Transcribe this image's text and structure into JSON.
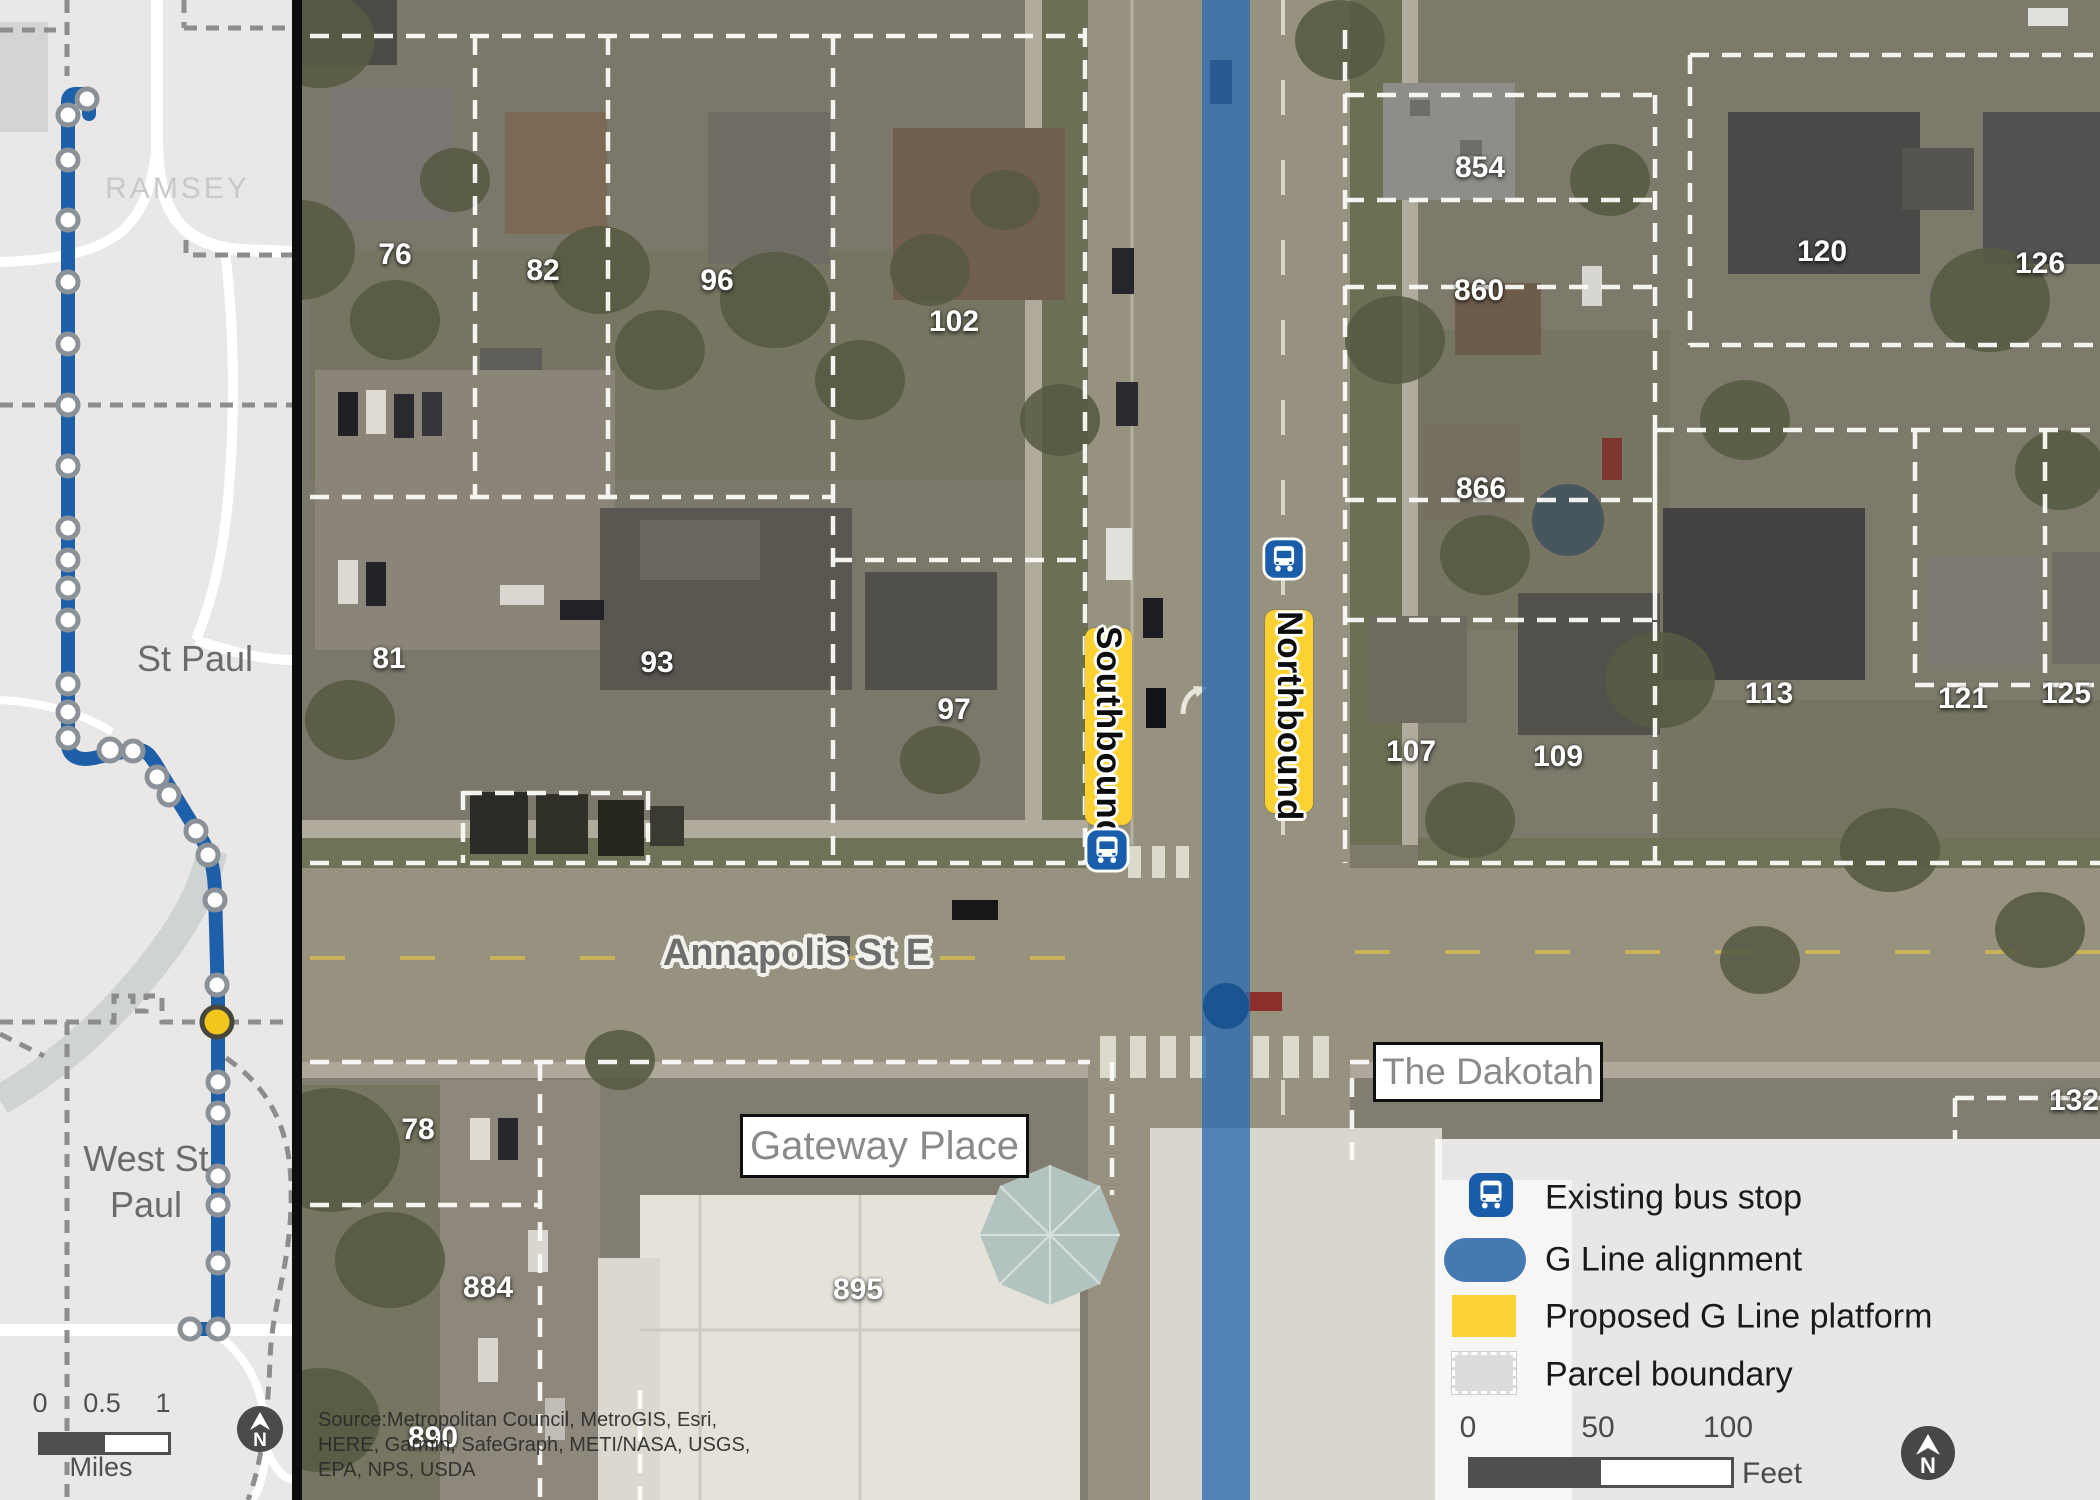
{
  "overview_map": {
    "county_label": "RAMSEY",
    "city1_label": "St Paul",
    "city2_line1": "West St",
    "city2_line2": "Paul",
    "scale_bar": {
      "ticks": [
        "0",
        "0.5",
        "1"
      ],
      "unit": "Miles"
    },
    "north_label": "N"
  },
  "aerial_map": {
    "street_label": "Annapolis St E",
    "place_labels": {
      "gateway": "Gateway Place",
      "dakotah": "The Dakotah"
    },
    "platforms": {
      "southbound": "Southbound",
      "northbound": "Northbound"
    },
    "parcel_numbers": [
      {
        "label": "76",
        "x": 395,
        "y": 255
      },
      {
        "label": "82",
        "x": 543,
        "y": 271
      },
      {
        "label": "96",
        "x": 717,
        "y": 281
      },
      {
        "label": "102",
        "x": 954,
        "y": 322
      },
      {
        "label": "854",
        "x": 1480,
        "y": 168
      },
      {
        "label": "860",
        "x": 1479,
        "y": 291
      },
      {
        "label": "866",
        "x": 1481,
        "y": 489
      },
      {
        "label": "120",
        "x": 1822,
        "y": 252
      },
      {
        "label": "126",
        "x": 2040,
        "y": 264
      },
      {
        "label": "81",
        "x": 389,
        "y": 659
      },
      {
        "label": "93",
        "x": 657,
        "y": 663
      },
      {
        "label": "97",
        "x": 954,
        "y": 710
      },
      {
        "label": "107",
        "x": 1411,
        "y": 752
      },
      {
        "label": "109",
        "x": 1558,
        "y": 757
      },
      {
        "label": "113",
        "x": 1769,
        "y": 694
      },
      {
        "label": "121",
        "x": 1963,
        "y": 699
      },
      {
        "label": "125",
        "x": 2066,
        "y": 694
      },
      {
        "label": "132",
        "x": 2074,
        "y": 1101
      },
      {
        "label": "78",
        "x": 418,
        "y": 1130
      },
      {
        "label": "884",
        "x": 488,
        "y": 1288
      },
      {
        "label": "895",
        "x": 858,
        "y": 1290
      },
      {
        "label": "890",
        "x": 433,
        "y": 1438
      }
    ],
    "source_lines": [
      "Source:Metropolitan Council, MetroGIS, Esri,",
      "HERE, Garmin, SafeGraph, METI/NASA, USGS,",
      "EPA, NPS, USDA"
    ]
  },
  "legend": {
    "items": [
      {
        "icon": "bus-stop-icon",
        "label": "Existing bus stop"
      },
      {
        "icon": "g-line-swatch",
        "label": "G Line alignment"
      },
      {
        "icon": "platform-swatch",
        "label": "Proposed G Line platform"
      },
      {
        "icon": "parcel-swatch",
        "label": "Parcel boundary"
      }
    ],
    "scale_bar": {
      "ticks": [
        "0",
        "50",
        "100"
      ],
      "unit": "Feet"
    },
    "north_label": "N"
  },
  "colors": {
    "g_line_blue": "#2a6cb0",
    "route_blue": "#1d5fa8",
    "bus_icon_blue": "#1a5dab",
    "platform_yellow": "#fbd232",
    "proposed_stop_yellow": "#f2c61a"
  }
}
